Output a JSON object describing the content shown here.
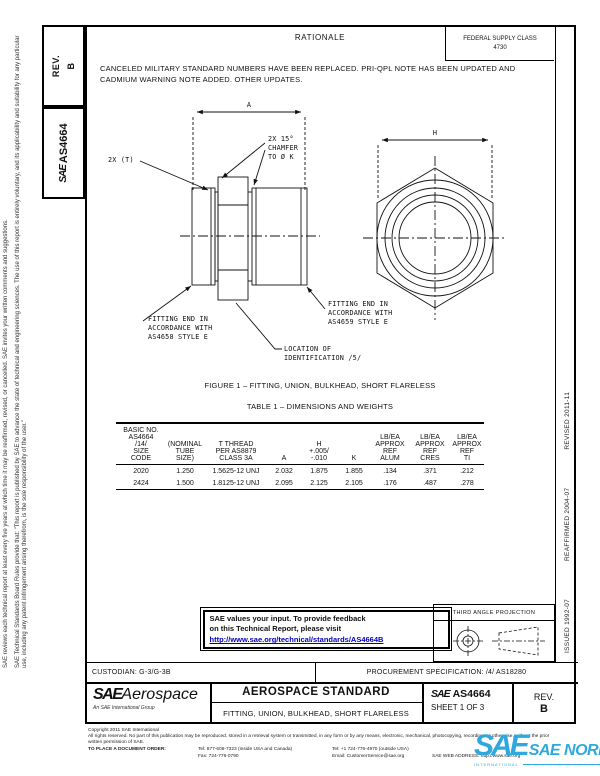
{
  "margin_left": {
    "disclaimer_outer": "SAE reviews each technical report at least every five years at which time it may be reaffirmed, revised, or cancelled. SAE invites your written comments and suggestions.",
    "disclaimer_inner": "SAE Technical Standards Board Rules provide that: \"This report is published by SAE to advance the state of technical and engineering sciences. The use of this report is entirely voluntary, and its applicability and suitability for any particular use, including any patent infringement arising therefrom, is the sole responsibility of the user.\""
  },
  "rev_box": {
    "label": "REV.",
    "value": "B"
  },
  "doc_box": {
    "logo": "SAE",
    "number": "AS4664"
  },
  "supply_box": {
    "line1": "FEDERAL SUPPLY CLASS",
    "line2": "4730"
  },
  "rationale": {
    "title": "RATIONALE",
    "body": "CANCELED MILITARY STANDARD NUMBERS HAVE BEEN REPLACED.  PRI-QPL NOTE HAS BEEN UPDATED AND CADMIUM WARNING NOTE ADDED.  OTHER UPDATES."
  },
  "figure": {
    "dim_a": "A",
    "dim_h": "H",
    "callout_2xt": "2X (T)",
    "callout_chamfer": "2X 15°\nCHAMFER\nTO Ø K",
    "callout_left_end": "FITTING END IN\nACCORDANCE WITH\nAS4658 STYLE E",
    "callout_right_end": "FITTING END IN\nACCORDANCE WITH\nAS4659 STYLE E",
    "callout_location": "LOCATION OF\nIDENTIFICATION /5/",
    "caption": "FIGURE 1 – FITTING, UNION, BULKHEAD, SHORT FLARELESS"
  },
  "table": {
    "title": "TABLE 1 – DIMENSIONS AND WEIGHTS",
    "headers": [
      "BASIC NO.\nAS4664\n/14/\nSIZE\nCODE",
      "(NOMINAL\nTUBE\nSIZE)",
      "T THREAD\nPER AS8879\nCLASS 3A",
      "A",
      "H\n+.005/\n-.010",
      "K",
      "LB/EA\nAPPROX\nREF\nALUM",
      "LB/EA\nAPPROX\nREF\nCRES",
      "LB/EA\nAPPROX\nREF\nTI"
    ],
    "rows": [
      [
        "2020",
        "1.250",
        "1.5625-12 UNJ",
        "2.032",
        "1.875",
        "1.855",
        ".134",
        ".371",
        ".212"
      ],
      [
        "2424",
        "1.500",
        "1.8125-12 UNJ",
        "2.095",
        "2.125",
        "2.105",
        ".176",
        ".487",
        ".278"
      ]
    ]
  },
  "feedback": {
    "line1": "SAE values your input. To provide feedback",
    "line2": "on this Technical Report, please visit",
    "link": "http://www.sae.org/technical/standards/AS4664B"
  },
  "projection": {
    "title": "THIRD ANGLE PROJECTION"
  },
  "footer": {
    "custodian": "CUSTODIAN:  G-3/G-3B",
    "procurement": "PROCUREMENT SPECIFICATION:  /4/  AS18280",
    "logo": "SAE",
    "logo_suffix": "Aerospace",
    "logo_sub": "An SAE International Group",
    "doc_type": "AEROSPACE STANDARD",
    "doc_title": "FITTING, UNION, BULKHEAD, SHORT FLARELESS",
    "num_prefix": "SAE",
    "number": "AS4664",
    "sheet": "SHEET 1 OF 3",
    "rev_label": "REV.",
    "rev_value": "B"
  },
  "revisions": {
    "issued": "ISSUED 1992-07",
    "reaffirmed": "REAFFIRMED 2004-07",
    "revised": "REVISED 2011-11"
  },
  "legal": {
    "copyright": "Copyright 2011 SAE International",
    "rights": "All rights reserved. No part of this publication may be reproduced, stored in a retrieval system or transmitted, in any form or by any means, electronic, mechanical, photocopying, recording, or otherwise, without the prior written permission of SAE.",
    "order_label": "TO PLACE A DOCUMENT ORDER:",
    "tel1": "Tel: 877-606-7323 (inside USA and Canada)",
    "tel2": "Tel: +1 724-776-4970 (outside USA)",
    "fax": "Fax: 724-776-0790",
    "email": "Email: CustomerService@sae.org",
    "web": "SAE WEB ADDRESS: http://www.sae.org"
  },
  "watermark": {
    "logo": "SAE",
    "text": "SAE NORM",
    "sub": "INTERNATIONAL"
  },
  "colors": {
    "link": "#0000bb",
    "watermark_blue": "#2fa9dd"
  }
}
